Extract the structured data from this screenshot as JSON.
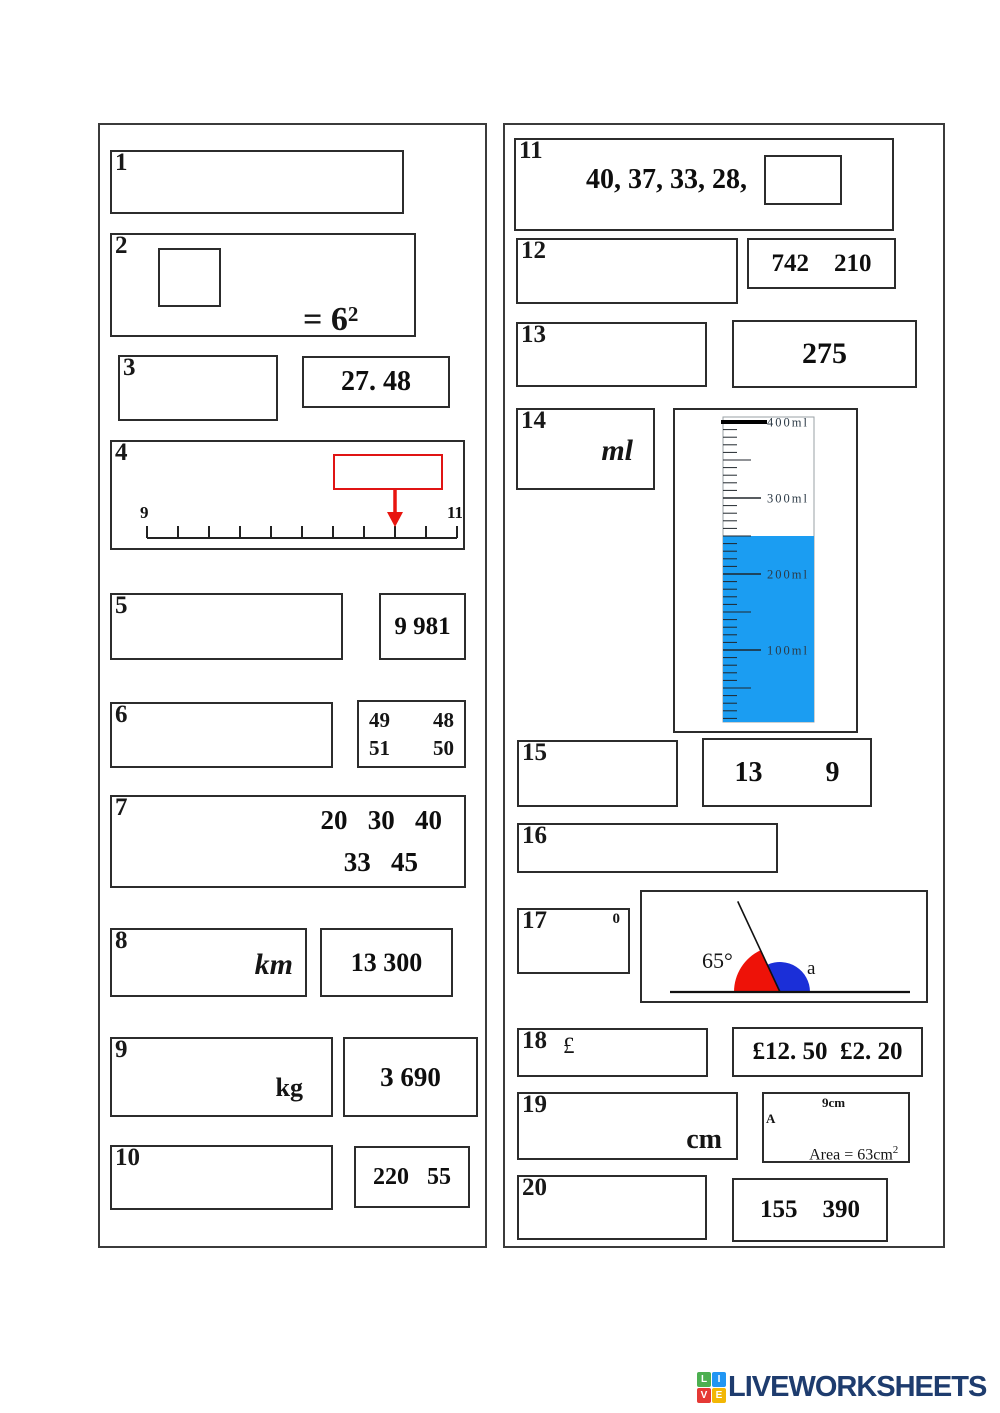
{
  "questions": {
    "q1": {
      "number": "1"
    },
    "q2": {
      "number": "2",
      "equals_text": "= 6",
      "exponent": "2"
    },
    "q3": {
      "number": "3",
      "answer": "27. 48"
    },
    "q4": {
      "number": "4"
    },
    "q5": {
      "number": "5",
      "answer": "9 981"
    },
    "q6": {
      "number": "6",
      "grid": {
        "top_left": "49",
        "top_right": "48",
        "bottom_left": "51",
        "bottom_right": "50"
      }
    },
    "q7": {
      "number": "7",
      "line1": "20   30   40",
      "line2": "33   45"
    },
    "q8": {
      "number": "8",
      "unit": "km",
      "answer": "13 300"
    },
    "q9": {
      "number": "9",
      "unit": "kg",
      "answer": "3 690"
    },
    "q10": {
      "number": "10",
      "answer": "220   55"
    },
    "q11": {
      "number": "11",
      "sequence": "40, 37, 33, 28,"
    },
    "q12": {
      "number": "12",
      "answer": "742    210"
    },
    "q13": {
      "number": "13",
      "answer": "275"
    },
    "q14": {
      "number": "14",
      "unit": "ml"
    },
    "q15": {
      "number": "15",
      "answer": "13         9"
    },
    "q16": {
      "number": "16"
    },
    "q17": {
      "number": "17",
      "degree_mark": "0"
    },
    "q18": {
      "number": "18",
      "currency": "£",
      "answer": "£12. 50  £2. 20"
    },
    "q19": {
      "number": "19",
      "unit": "cm",
      "rectangle": {
        "width_label": "9cm",
        "side_label": "A",
        "area_text": "Area = 63cm",
        "area_exponent": "2"
      }
    },
    "q20": {
      "number": "20",
      "answer": "155    390"
    }
  },
  "chart_data": [
    {
      "type": "other",
      "widget": "measuring-cylinder",
      "title": "Q14 measuring cylinder",
      "unit": "ml",
      "scale_min": 0,
      "scale_max": 400,
      "minor_step": 10,
      "major_marks": [
        400,
        300,
        200,
        100
      ],
      "mark_labels": [
        "400ml",
        "300ml",
        "200ml",
        "100ml"
      ],
      "water_level": 250,
      "water_color": "#1b9df2"
    },
    {
      "type": "other",
      "widget": "number-line",
      "title": "Q4 number line",
      "start": 9,
      "end": 11,
      "start_label": "9",
      "end_label": "11",
      "tick_count": 11,
      "arrow_value": 10.6,
      "arrow_color": "#e8150f"
    },
    {
      "type": "other",
      "widget": "angle-diagram",
      "title": "Q17 angles on a straight line",
      "known_angle_deg": 65,
      "known_label": "65°",
      "known_color": "#ee1208",
      "unknown_label": "a",
      "unknown_color": "#1b2fd8"
    }
  ],
  "footer": {
    "logo_text": "LIVEWORKSHEETS",
    "logo_color": "#1e3c6e",
    "logo_squares": [
      {
        "letter": "L",
        "color": "#4caf50"
      },
      {
        "letter": "I",
        "color": "#2196f3"
      },
      {
        "letter": "V",
        "color": "#e53935"
      },
      {
        "letter": "E",
        "color": "#f2b705"
      }
    ]
  }
}
